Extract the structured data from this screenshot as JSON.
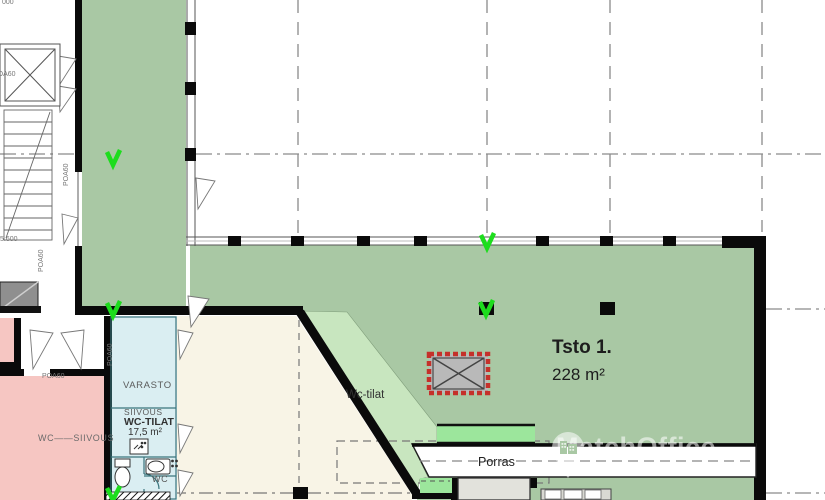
{
  "watermark": {
    "brand": "MatchOffice",
    "icon": "map-pin-building-icon"
  },
  "unit": {
    "name": "Tsto 1.",
    "area": "228 m²"
  },
  "rooms": {
    "porras": "Porras",
    "wc_corridor": "Wc-tilat",
    "varasto": "VARASTO",
    "siivous": "SIIVOUS",
    "wc_tilat": "WC-TILAT",
    "wc_tilat_area": "17,5 m²",
    "wc": "WC",
    "wc_siivous": "WC——SIIVOUS"
  },
  "door_tags": {
    "lift": "POA60",
    "stair_door": "POA60",
    "corridor_door": "POA60",
    "storage_door": "POA60",
    "cleaning_door": "POA60"
  },
  "levels": {
    "top": "000",
    "stair": "5.600"
  },
  "colors": {
    "green_main": "#a9c8a4",
    "green_light": "#c8e6bf",
    "green_bright": "#9ce69c",
    "blue_room": "#daeef2",
    "pink_room": "#f6c6c2",
    "cream_room": "#f8f4e6",
    "gray_dark": "#8f8f8f",
    "gray_light": "#e2e2dc",
    "wall_black": "#0a0a0a",
    "marker_green": "#1ddd1d",
    "reserved_red": "#c5302a",
    "grid_gray": "#9a9a9a"
  }
}
